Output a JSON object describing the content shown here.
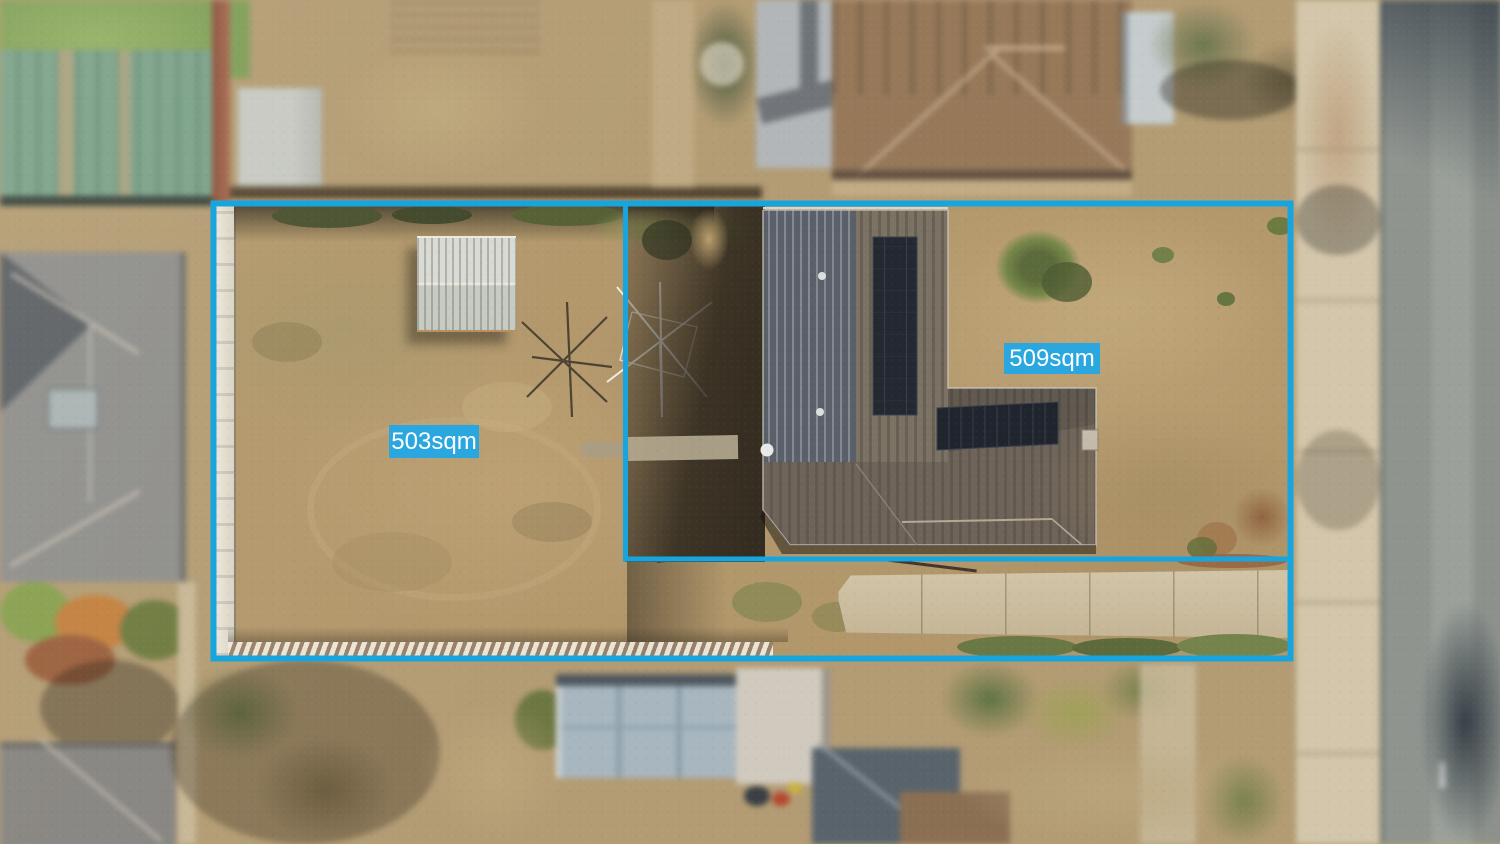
{
  "photo": {
    "annotations": {
      "lot_left_area": "503sqm",
      "lot_right_area": "509sqm"
    },
    "colors": {
      "boundary_line": "#18a5de",
      "label_background": "#2ba7df",
      "label_text": "#ffffff"
    }
  }
}
